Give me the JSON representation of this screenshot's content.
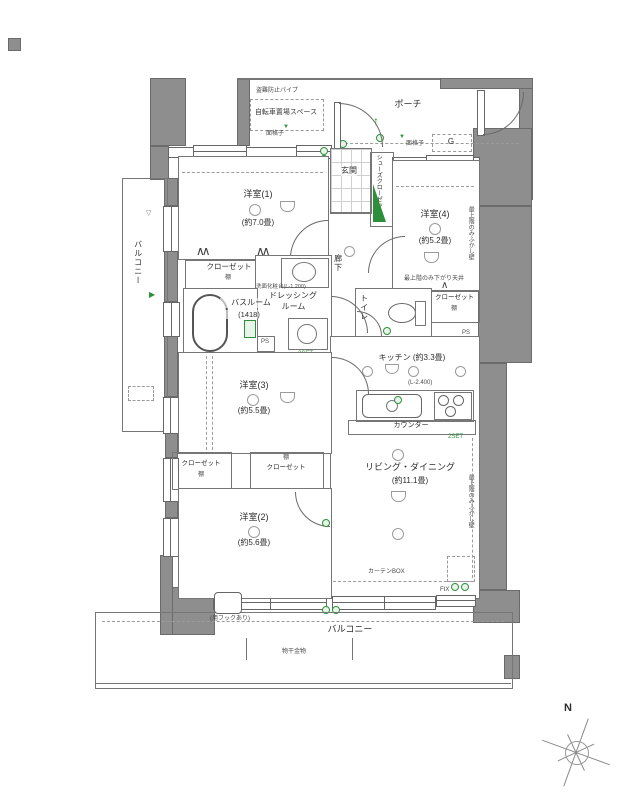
{
  "rooms": {
    "yo1": {
      "name": "洋室(1)",
      "size": "(約7.0畳)"
    },
    "yo2": {
      "name": "洋室(2)",
      "size": "(約5.6畳)"
    },
    "yo3": {
      "name": "洋室(3)",
      "size": "(約5.5畳)"
    },
    "yo4": {
      "name": "洋室(4)",
      "size": "(約5.2畳)"
    },
    "ld": {
      "name": "リビング・ダイニング",
      "size": "(約11.1畳)"
    },
    "kitchen": {
      "name": "キッチン (約3.3畳)"
    },
    "genkan": {
      "name": "玄関"
    },
    "hall": {
      "name": "廊下"
    },
    "shoes": {
      "name": "シューズクローゼット"
    },
    "toilet": {
      "name": "トイレ"
    },
    "bath": {
      "name": "バスルーム",
      "size": "(1418)"
    },
    "dressing": {
      "line1": "ドレッシング",
      "line2": "ルーム"
    },
    "porch": {
      "name": "ポーチ"
    },
    "balcony_left": {
      "name": "バルコニー"
    },
    "balcony_bottom": {
      "name": "バルコニー"
    }
  },
  "labels": {
    "closet": "クローゼット",
    "shelf": "棚",
    "counter": "カウンター",
    "curtain_box": "カーテンBOX",
    "fix": "FIX",
    "monohoshi": "物干金物",
    "hook_note": "(用フックあり)",
    "bike": "自転車置場スペース",
    "anti_theft": "盗難防止パイプ",
    "menkoushi": "面格子",
    "koshimado": "腰窓",
    "g": "G",
    "mb": "MB",
    "ps": "PS",
    "vanity": "洗面化粧台(L-1.200)",
    "l2400": "(L-2.400)",
    "sagari_tenjo": "最上階のみ下がり天井",
    "fukashi_kabe": "最上階のみふかし壁",
    "outlet": "2SET",
    "north": "N",
    "fold_double": "∧∧",
    "fold_single": "∧",
    "tri_down": "▽",
    "tri_down_green": "▼",
    "tri_right_green": "▶",
    "arrow_up": "↑"
  }
}
